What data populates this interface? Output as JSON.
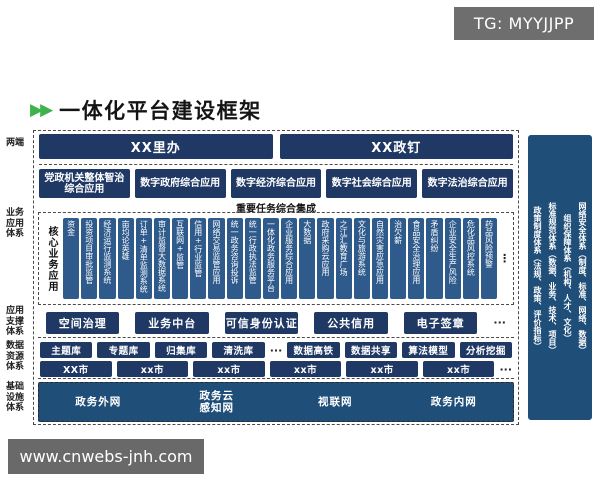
{
  "badge": {
    "text": "TG: MYYJJPP"
  },
  "watermark": {
    "text": "www.cnwebs-jnh.com"
  },
  "header": {
    "title": "一体化平台建设框架"
  },
  "icons": {
    "double_arrow": "▶▶",
    "more_horizontal": "···",
    "more_vertical": "⋮"
  },
  "colors": {
    "accent_green": "#3db34a",
    "navy": "#1f3864",
    "steel_blue": "#2e5a8c",
    "panel_blue": "#1f4e79",
    "badge_gray": "#6e6e6e"
  },
  "left_labels": {
    "terminals": "两端",
    "business": "业务应用体系",
    "support": "应用支撑体系",
    "data": "数据资源体系",
    "infra": "基础设施体系"
  },
  "terminals": [
    "XX里办",
    "XX政钉"
  ],
  "apps": [
    "党政机关整体智治综合应用",
    "数字政府综合应用",
    "数字经济综合应用",
    "数字社会综合应用",
    "数字法治综合应用"
  ],
  "integration_label": "重要任务综合集成",
  "core": {
    "label": "核心业务应用",
    "bars": [
      "资金",
      "投资项目审批监管",
      "经济运行监测系统",
      "亩均论英雄",
      "订单+清单监测系统",
      "审计监督大数据系统",
      "互联网+监管",
      "信用+行业监管",
      "网络交易监管应用",
      "统一政务咨询投诉",
      "统一行政执法监管",
      "一体化政务服务平台",
      "企业服务综合应用",
      "大数据",
      "政府采购云应用",
      "之江汇教育广场",
      "文化与旅游系统",
      "自然灾害应急应用",
      "治欠薪",
      "食品安全治理应用",
      "矛盾纠纷",
      "企业安全生产风险",
      "危化品风控系统",
      "药品风险预警"
    ],
    "more": "⋮"
  },
  "support": {
    "items": [
      "空间治理",
      "业务中台",
      "可信身份认证",
      "公共信用",
      "电子签章"
    ],
    "more": "···"
  },
  "data_layer": {
    "libraries": [
      "主题库",
      "专题库",
      "归集库",
      "清洗库"
    ],
    "libraries_more": "···",
    "services": [
      "数据高铁",
      "数据共享",
      "算法模型",
      "分析挖掘"
    ],
    "cities": [
      "XX市",
      "xx市",
      "xx市",
      "xx市",
      "xx市",
      "xx市"
    ],
    "cities_more": "···"
  },
  "infra": {
    "items": [
      {
        "name": "政务外网"
      },
      {
        "name": "政务云",
        "name2": "感知网"
      },
      {
        "name": "视联网"
      },
      {
        "name": "政务内网"
      }
    ]
  },
  "right_panel": {
    "columns": [
      "政策制度体系（法规、政策、评价指标）",
      "标准规范体系（数据、业务、技术、项目）",
      "组织保障体系（机构、人才、文化）",
      "网络安全体系（制度、标准、网络、数据）"
    ]
  }
}
